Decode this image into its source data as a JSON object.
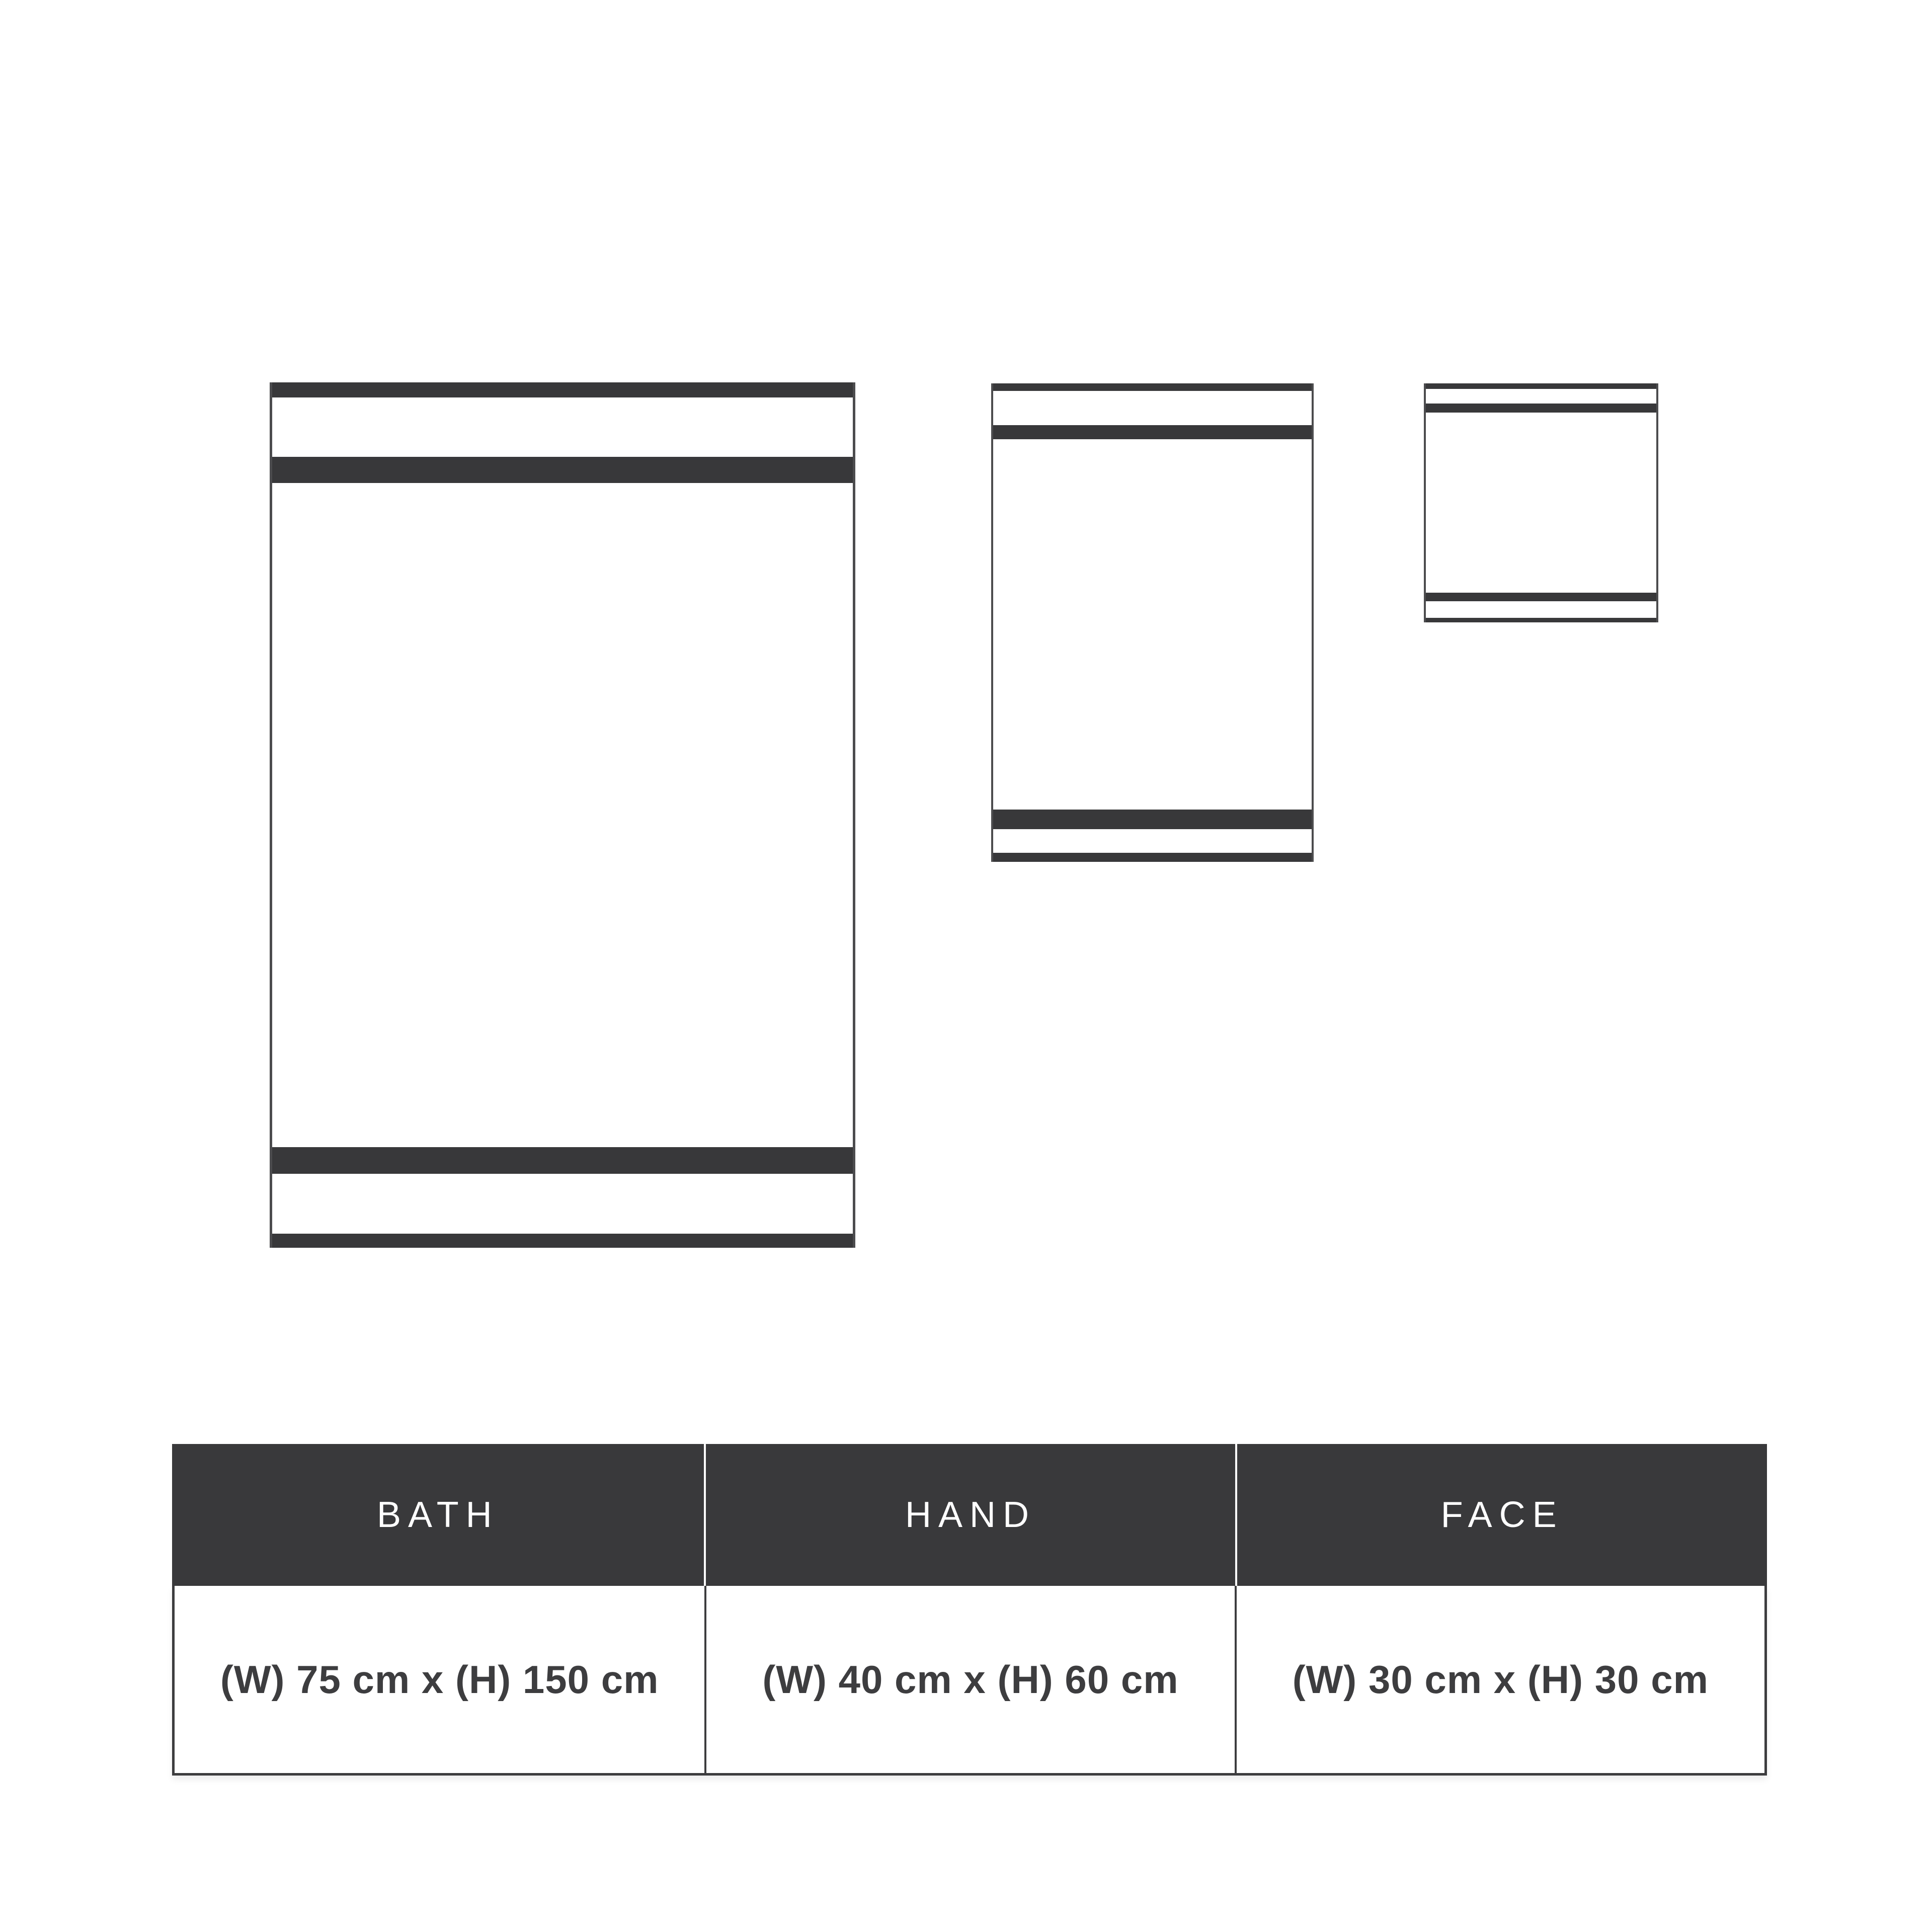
{
  "page": {
    "background": "#ffffff",
    "description": "Towel size comparison diagram with bath, hand and face towel graphics and a dimensions table"
  },
  "colors": {
    "stripe_dark": "#38383a",
    "towel_outline": "#4c4c4e",
    "table_header_bg": "#39393b",
    "table_header_text": "#ffffff",
    "table_body_text": "#3d3d3f",
    "table_border": "#3d3d3f"
  },
  "towels": [
    {
      "id": "bath",
      "label": "BATH",
      "size": "(W) 75 cm x (H) 150 cm"
    },
    {
      "id": "hand",
      "label": "HAND",
      "size": "(W) 40 cm x (H) 60 cm"
    },
    {
      "id": "face",
      "label": "FACE",
      "size": "(W) 30 cm x (H) 30 cm"
    }
  ],
  "table": {
    "columns": [
      {
        "label": "BATH",
        "size": "(W) 75 cm x (H) 150 cm"
      },
      {
        "label": "HAND",
        "size": "(W) 40 cm x (H) 60 cm"
      },
      {
        "label": "FACE",
        "size": "(W) 30 cm x (H) 30 cm"
      }
    ]
  },
  "chart_data": {
    "type": "table",
    "title": "Towel dimensions",
    "columns": [
      "BATH",
      "HAND",
      "FACE"
    ],
    "rows": [
      [
        "(W) 75 cm x (H) 150 cm",
        "(W) 40 cm x (H) 60 cm",
        "(W) 30 cm x (H) 30 cm"
      ]
    ],
    "dimensions_cm": [
      {
        "name": "BATH",
        "width": 75,
        "height": 150
      },
      {
        "name": "HAND",
        "width": 40,
        "height": 60
      },
      {
        "name": "FACE",
        "width": 30,
        "height": 30
      }
    ]
  }
}
